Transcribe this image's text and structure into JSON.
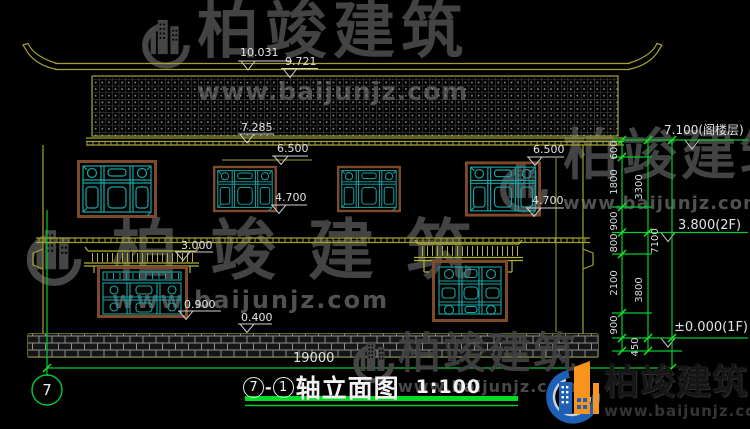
{
  "watermark": {
    "brand": "柏竣建筑",
    "url": "www.baijunjz.com"
  },
  "markers": {
    "ridge_top": "10.031",
    "ridge": "9.721",
    "eave": "7.285",
    "window2f_head_left": "6.500",
    "window2f_sill_left": "4.700",
    "window2f_head_right": "6.500",
    "window2f_sill_right": "4.700",
    "awning_1f": "3.000",
    "window1f_sill": "0.900",
    "plinth_top": "0.400"
  },
  "floor_levels": {
    "attic": "7.100(阁楼层)",
    "second": "3.800(2F)",
    "first": "±0.000(1F)"
  },
  "vertical_dims": {
    "inner": [
      "600",
      "1800",
      "900",
      "800",
      "2100",
      "900",
      "450"
    ],
    "middle": [
      "3300",
      "3800"
    ],
    "overall": "7100"
  },
  "horizontal_dims": {
    "total_width": "19000"
  },
  "axis": {
    "grid_bubble": "7"
  },
  "title": {
    "axis_start": "7",
    "separator": "-",
    "axis_end": "1",
    "name": "轴立面图",
    "scale": "1:100"
  }
}
